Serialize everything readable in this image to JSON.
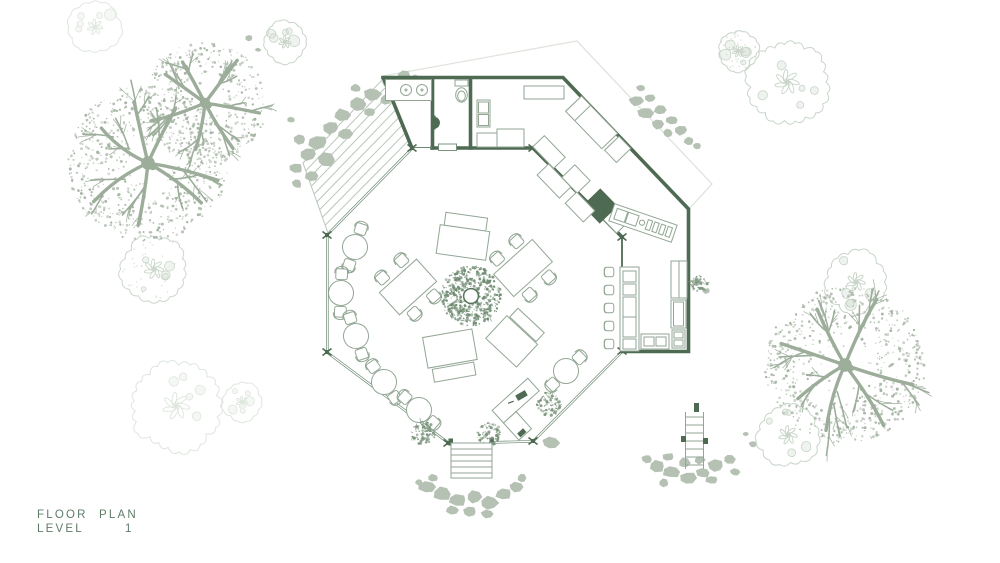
{
  "title": {
    "line1": [
      "FLOOR",
      "PLAN"
    ],
    "line2": [
      "LEVEL",
      "1"
    ]
  },
  "colors": {
    "wall": "#4e6a52",
    "window": "#6e8a74",
    "furniture": "#92a694",
    "tree_foliage": "#a4b3a2",
    "tree_branch": "#9cad9a",
    "rock": "#b5c1b3",
    "outline_tree": "#c6d3c6",
    "outline_tree_faint": "#dde5dc",
    "roof": "#dfe5dd",
    "plant": "#7b947c",
    "planter": "#6f8b72",
    "text": "#5f7c68",
    "background": "#ffffff"
  }
}
